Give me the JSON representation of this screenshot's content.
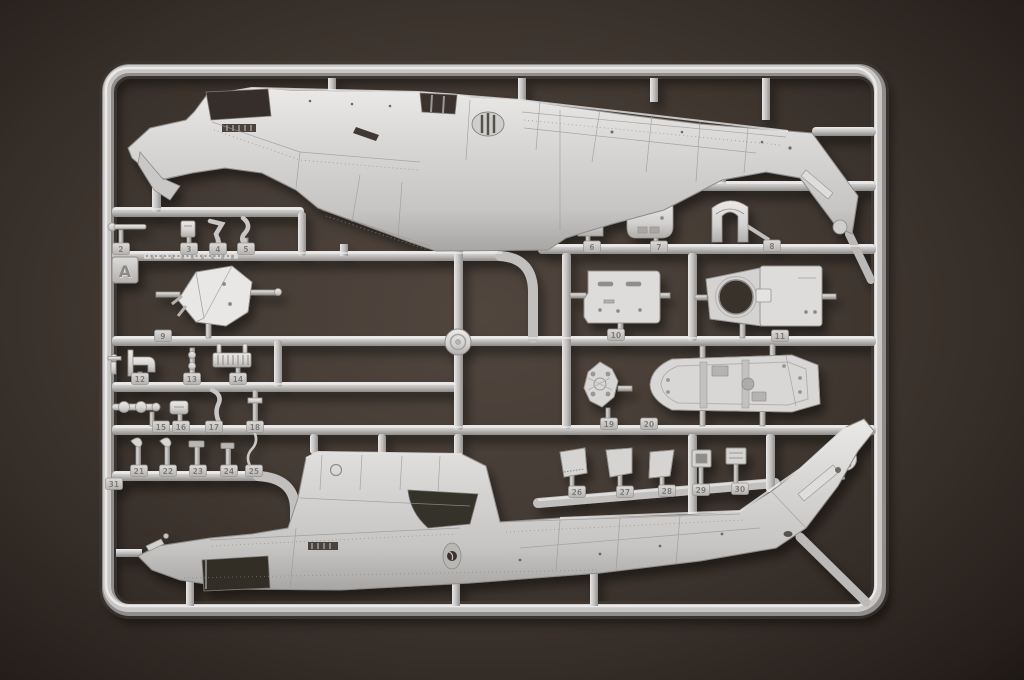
{
  "image": {
    "type": "photograph",
    "subject": "Injection-molded plastic model kit sprue (runner) holding helicopter parts",
    "background_surface": "dark brown textured board"
  },
  "sprue": {
    "letter_tag": "A",
    "part_tag_numbers": [
      "2",
      "3",
      "4",
      "5",
      "6",
      "7",
      "8",
      "9",
      "10",
      "11",
      "12",
      "13",
      "14",
      "15",
      "16",
      "17",
      "18",
      "19",
      "20",
      "21",
      "22",
      "23",
      "24",
      "25",
      "26",
      "27",
      "28",
      "29",
      "30",
      "31"
    ],
    "embossed_marking": "illegible raised molded lettering on left runner bar",
    "parts_depicted": [
      "upper fuselage half with cockpit window cutouts and down-swept tail fin",
      "lower fuselage half with engine cowling hump, open bay and up-swept tail fin",
      "cockpit floor tub",
      "engine deck panel with slots",
      "bulkhead panel with large circular rotor-shaft opening",
      "gearbox cowling",
      "instrument panel",
      "seat frame arch",
      "tail-rotor hub disc",
      "assorted antennas, rods, levers, grilles, brackets and small access panels"
    ],
    "colors": {
      "plastic_highlight": "#eceae8",
      "plastic_mid": "#c6c4c2",
      "plastic_shadow": "#908e8c",
      "tag_number_ink": "#7d7a76"
    }
  },
  "background_colors": {
    "center": "#51463e",
    "edge": "#261f1b"
  }
}
